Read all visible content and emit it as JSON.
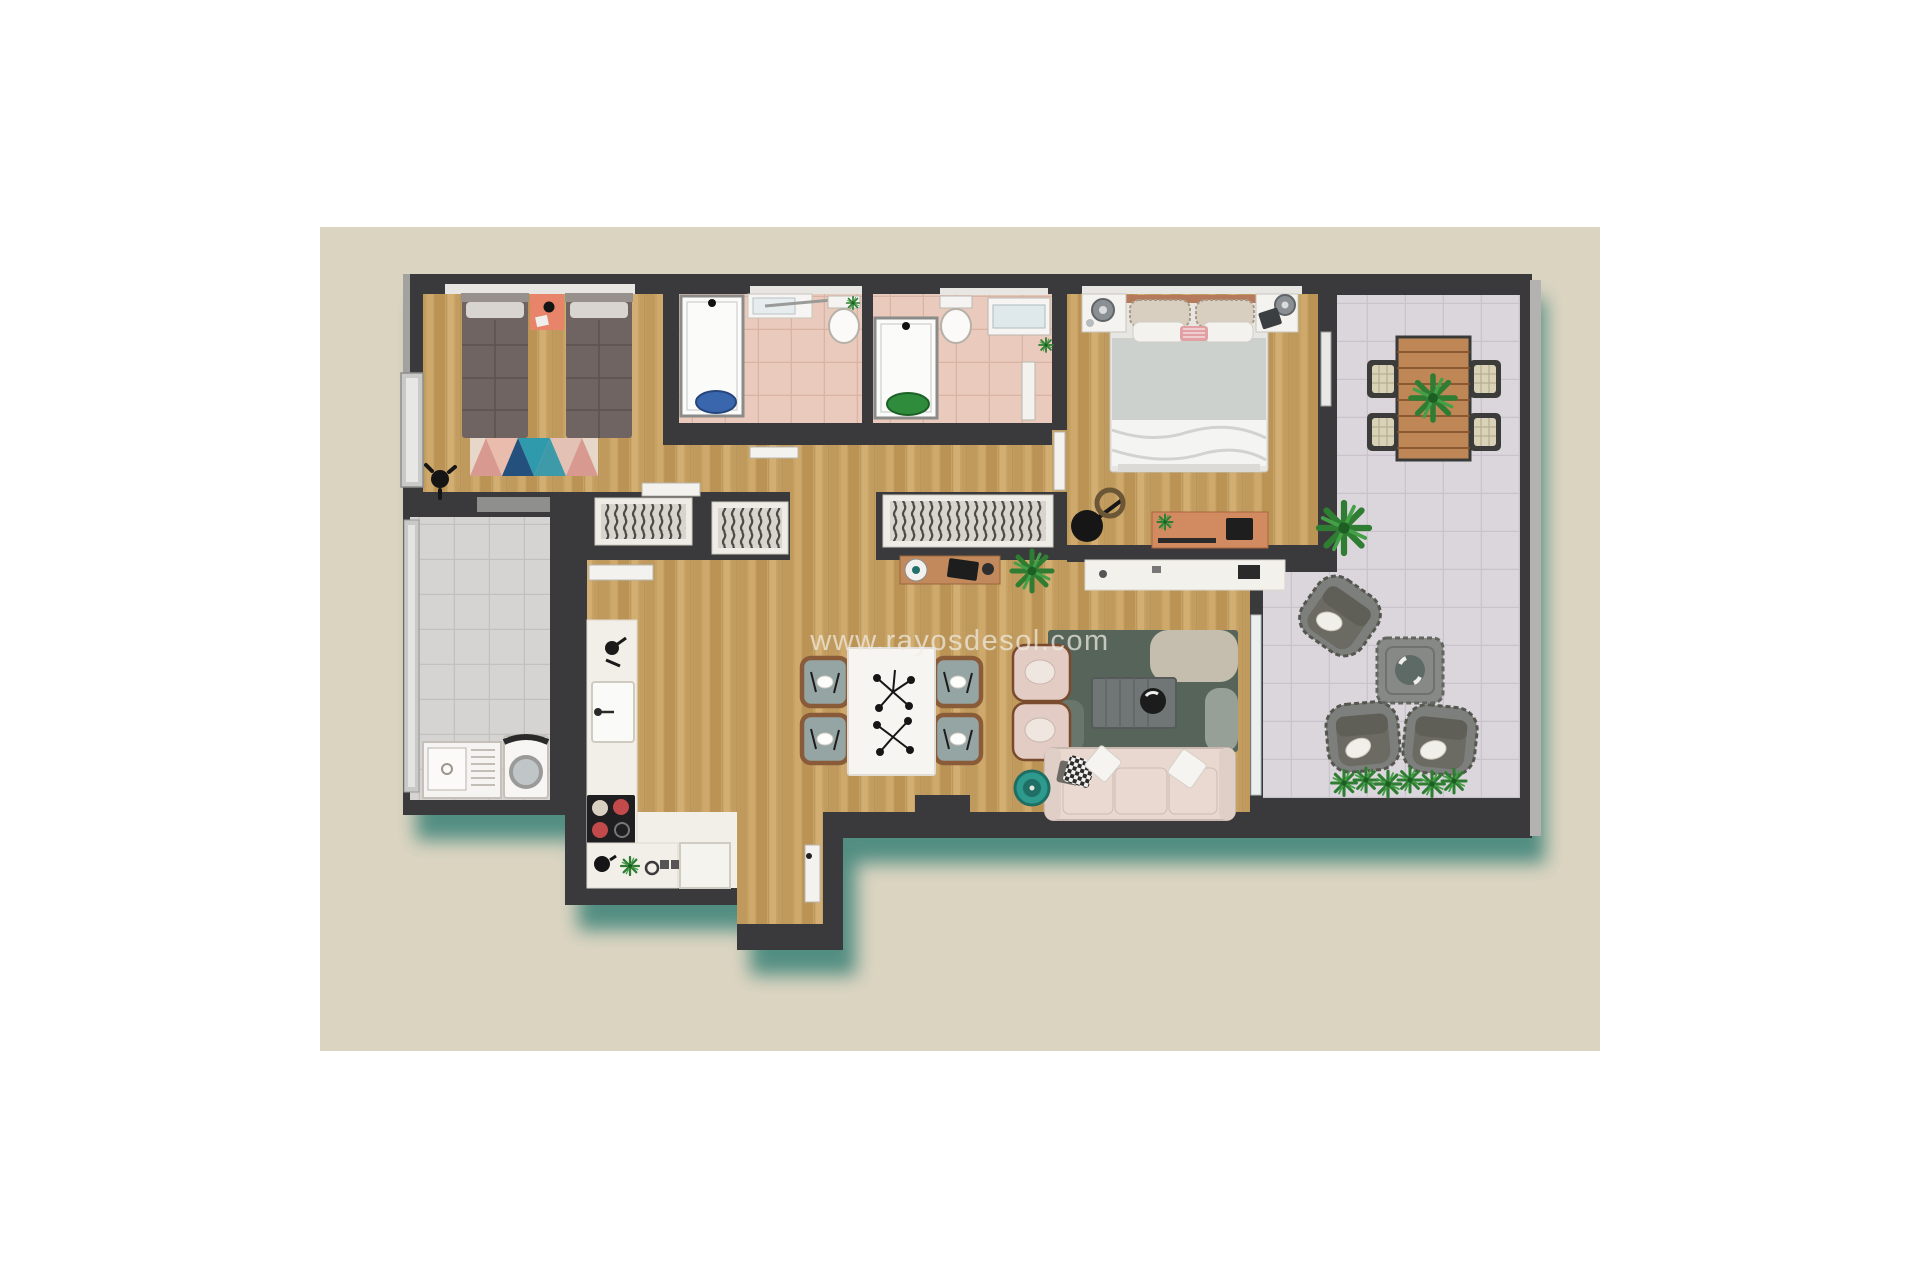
{
  "watermark": {
    "text": "www.rayosdesol.com",
    "color": "#f0ece2"
  },
  "canvas": {
    "background": "#dbd4c1"
  },
  "palette": {
    "page_background": "#ffffff",
    "wall": "#3a3a3c",
    "shadow": "#4c8a7f",
    "wood_floor": "#c7a265",
    "bathroom_tile": "#e9cabc",
    "utility_tile": "#d5d4d2",
    "terrace_tile": "#dbd6dc",
    "kitchen_counter": "#f2efe9",
    "accent_coral": "#e8846a",
    "accent_teal": "#2d9a8d",
    "plant_green": "#2e7d32",
    "sofa_beige": "#e8d8d0",
    "rug_dark_green": "#57645a",
    "duvet_gray": "#ccd1cd",
    "single_bed_gray": "#6f6461",
    "wicker_gray": "#7b7d7b",
    "terrace_wood": "#bf8756"
  }
}
